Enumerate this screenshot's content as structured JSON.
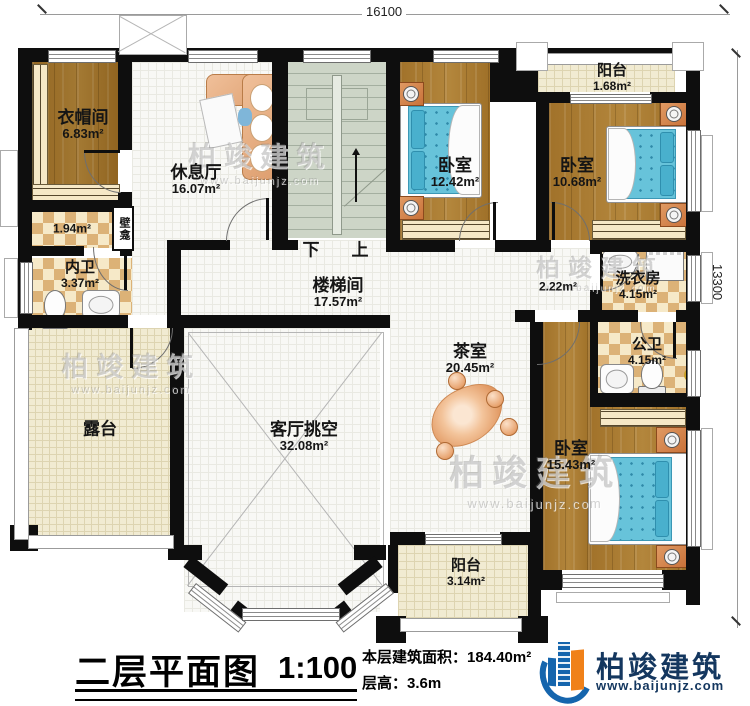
{
  "dimensions": {
    "top": "16100",
    "right": "13300"
  },
  "rooms": {
    "cloakroom": {
      "name": "衣帽间",
      "area": "6.83m²"
    },
    "lounge": {
      "name": "休息厅",
      "area": "16.07m²"
    },
    "bedroom_top_left": {
      "name": "卧室",
      "area": "12.42m²"
    },
    "bedroom_top_right": {
      "name": "卧室",
      "area": "10.68m²"
    },
    "balcony_top": {
      "name": "阳台",
      "area": "1.68m²"
    },
    "closet": {
      "area": "1.94m²"
    },
    "niche": {
      "name": "壁龛"
    },
    "inner_bath": {
      "name": "内卫",
      "area": "3.37m²"
    },
    "stair_hall": {
      "name": "楼梯间",
      "area": "17.57m²"
    },
    "nook": {
      "area": "2.22m²"
    },
    "laundry": {
      "name": "洗衣房",
      "area": "4.15m²"
    },
    "public_bath": {
      "name": "公卫",
      "area": "4.15m²"
    },
    "tea_room": {
      "name": "茶室",
      "area": "20.45m²"
    },
    "living_void": {
      "name": "客厅挑空",
      "area": "32.08m²"
    },
    "terrace": {
      "name": "露台"
    },
    "bedroom_bottom": {
      "name": "卧室",
      "area": "15.43m²"
    },
    "balcony_bottom": {
      "name": "阳台",
      "area": "3.14m²"
    }
  },
  "stairs": {
    "down_label": "下",
    "up_label": "上"
  },
  "title_block": {
    "title": "二层平面图",
    "scale": "1:100",
    "area_label": "本层建筑面积：",
    "area_value": "184.40m²",
    "floor_height_label": "层高：",
    "floor_height_value": "3.6m"
  },
  "brand": {
    "name": "柏竣建筑",
    "website": "www.baijunjz.com"
  },
  "watermark": {
    "name": "柏竣建筑",
    "website": "www.baijunjz.com"
  },
  "colors": {
    "wall": "#0e0e0e",
    "wood_floor": "#a87a2f",
    "checker_tile": "#dcb277",
    "bed": "#67c3da",
    "stairs": "#cdd5c7",
    "balcony_tile": "#f1ebd2",
    "brand_blue": "#1565ad",
    "brand_orange": "#f08119",
    "brand_navy": "#14375f"
  }
}
